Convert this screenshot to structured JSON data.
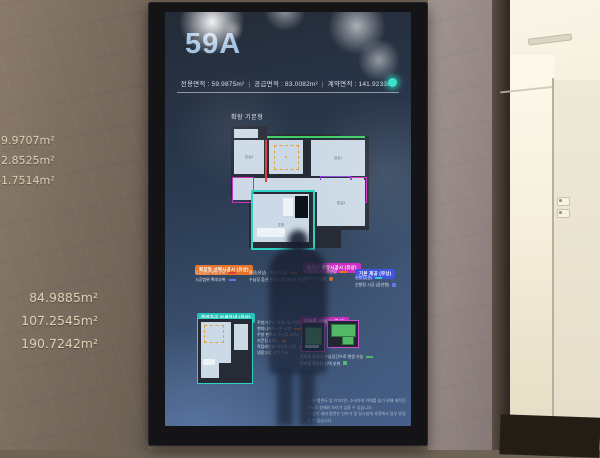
{
  "wall_engravings": {
    "group1": [
      "59.9707m²",
      "82.8525m²",
      "41.7514m²"
    ],
    "group2": [
      "84.9885m²",
      "107.2545m²",
      "190.7242m²"
    ]
  },
  "kiosk": {
    "unit_title": "59A",
    "area_line": {
      "items": [
        "전용면적 : 59.9875m²",
        "공급면적 : 83.0082m²",
        "계약면적 : 141.9233m²"
      ],
      "separator": "|"
    },
    "plan": {
      "type_label": "확장 기본형",
      "rooms": {
        "bedroom2": "침실2",
        "living": "거실",
        "bedroom1": "침실1",
        "kitchen": "주방",
        "bedroom3": "침실3",
        "bath": "욕실",
        "alpha": "알파룸"
      }
    },
    "legend_groups": [
      {
        "title": "확장형 선택시공시 (유상)",
        "accent": "#e4752c",
        "items": [
          {
            "text": "무상옵션 확장부위"
          },
          {
            "text": "확장(유상) · 기본(무상)"
          },
          {
            "text": "시공범위 확대부위"
          },
          {
            "text": "수납장 옵션 선택시 추가비용 발생"
          }
        ]
      },
      {
        "title": "발코니 확장시공시 (유상)",
        "accent": "#cc2fc2",
        "items": [
          {
            "text": "수납장형 2단 선반장"
          },
          {
            "text": "펜트리 수납장"
          }
        ]
      },
      {
        "title": "기본 제공 (무상)",
        "accent": "#3f55e0",
        "items": [
          {
            "text": "신발장(중)"
          },
          {
            "text": "신발장 시공 (옵션형)"
          }
        ]
      }
    ],
    "kitchen_inset": {
      "title": "주방가구 상세안내 (유상)",
      "accent": "#2ac2b8",
      "notes": [
        "주방가구(ㄷ자형) 및 아일랜드장",
        "엔지니어드스톤 상판",
        "주방 팬트리 수납장 2개소",
        "키큰장 2개소",
        "쿡탑레인지 하부장 시공",
        "냉장고장 상부 수납"
      ]
    },
    "alpha_inset": {
      "title": "알파룸 선택시 (유상)",
      "accent": "#cc2fc2",
      "notes": [
        "알파룸 요청시 수납공간으로 변경 가능",
        "알파룸 확장형 선택 부위"
      ]
    },
    "disclaimer": [
      "※ 본 평면도 및 이미지는 소비자의 이해를 돕기 위해 제작된 것으로 실제와 차이가 있을 수 있습니다.",
      "※ 상기 세대 평면은 인허가 및 실시설계 과정에서 일부 변경될 수 있습니다."
    ]
  },
  "colors": {
    "accent_orange": "#e4752c",
    "accent_magenta": "#cc2fc2",
    "accent_blue": "#3f55e0",
    "accent_teal": "#2ed2c2",
    "accent_green": "#3fcf68",
    "accent_red": "#e23c3c",
    "accent_purple": "#8a46d8",
    "title_blue": "#a3c2e2",
    "screen_bg_top": "#242b37",
    "screen_bg_bottom": "#46608a"
  }
}
